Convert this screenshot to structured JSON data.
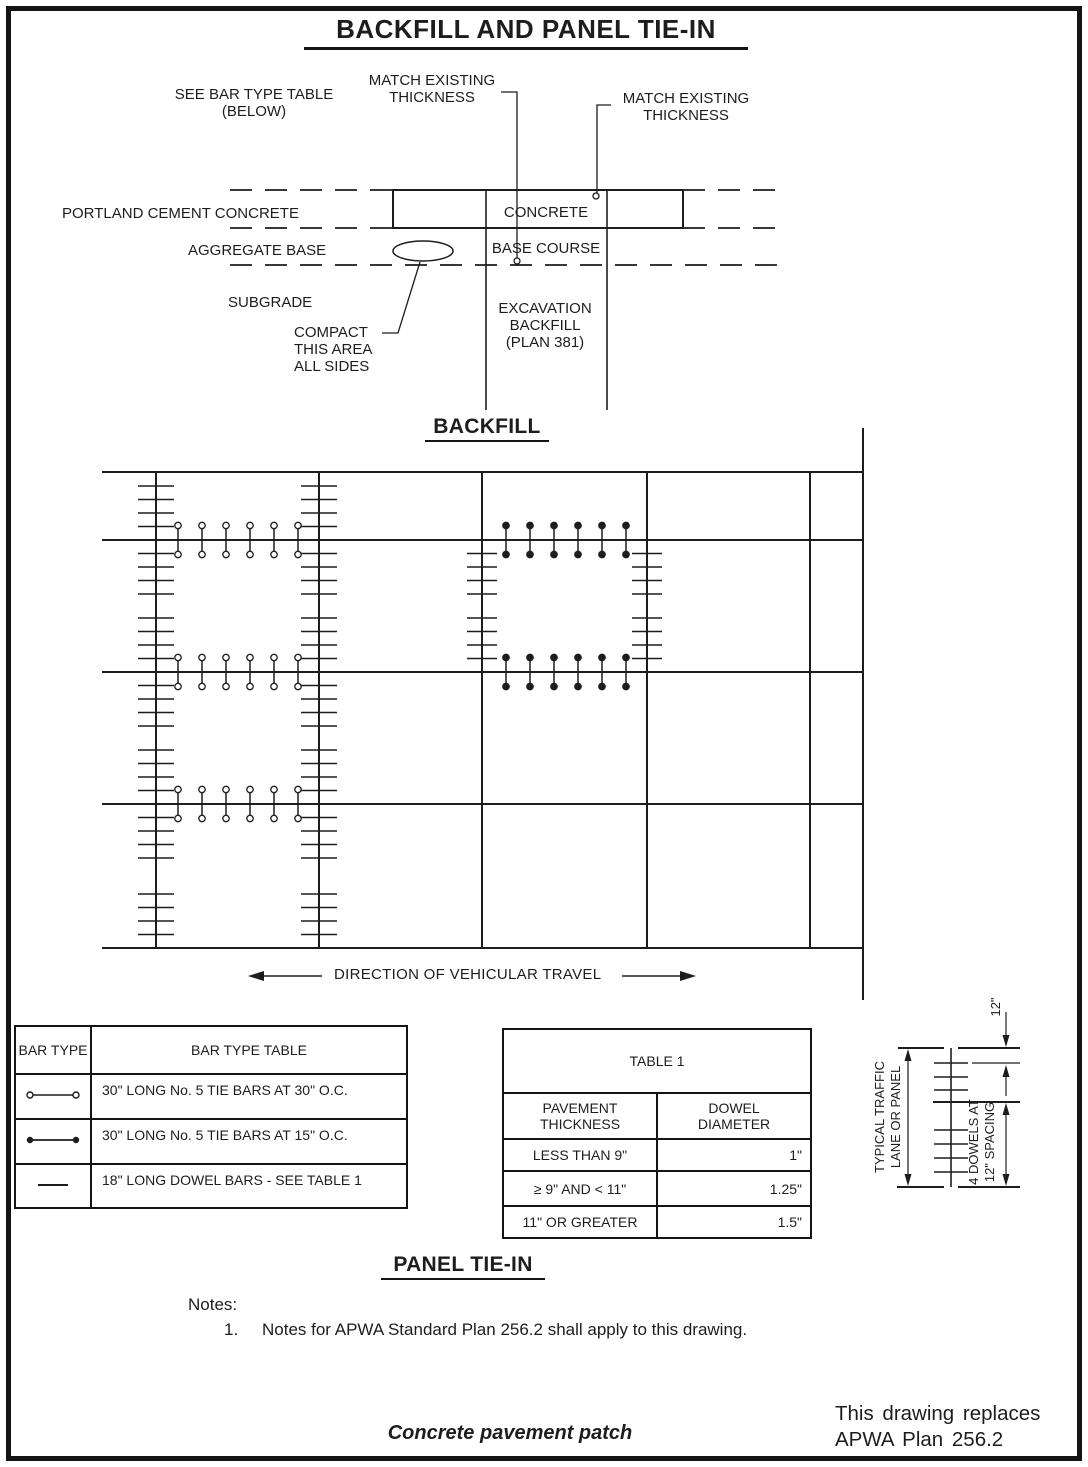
{
  "page": {
    "title": "BACKFILL AND PANEL TIE-IN",
    "section1_heading": "BACKFILL",
    "section2_heading": "PANEL TIE-IN"
  },
  "cross_section": {
    "see_bar_type_table": "SEE BAR TYPE TABLE (BELOW)",
    "match_existing_1": "MATCH EXISTING THICKNESS",
    "match_existing_2": "MATCH EXISTING THICKNESS",
    "portland_cement_concrete": "PORTLAND CEMENT CONCRETE",
    "aggregate_base": "AGGREGATE BASE",
    "subgrade": "SUBGRADE",
    "compact_area": "COMPACT THIS AREA ALL SIDES",
    "concrete": "CONCRETE",
    "base_course": "BASE COURSE",
    "excavation_backfill": "EXCAVATION BACKFILL (PLAN 381)"
  },
  "plan_view": {
    "direction_label": "DIRECTION OF VEHICULAR TRAVEL"
  },
  "detail": {
    "dim_12": "12\"",
    "typical_line1": "TYPICAL TRAFFIC",
    "typical_line2": "LANE OR PANEL",
    "dowels_line1": "4 DOWELS AT",
    "dowels_line2": "12\" SPACING"
  },
  "bar_type_table": {
    "col1_header": "BAR TYPE",
    "col2_header": "BAR TYPE TABLE",
    "rows": [
      {
        "symbol": "tie-bar-open-circles",
        "desc": "30\" LONG No. 5 TIE BARS AT 30\" O.C."
      },
      {
        "symbol": "tie-bar-filled-circles",
        "desc": "30\" LONG No. 5 TIE BARS AT 15\" O.C."
      },
      {
        "symbol": "dowel-bar-plain-line",
        "desc": "18\" LONG DOWEL BARS - SEE TABLE 1"
      }
    ]
  },
  "table1": {
    "title": "TABLE 1",
    "col1_header": "PAVEMENT THICKNESS",
    "col2_header": "DOWEL DIAMETER",
    "rows": [
      {
        "thickness": "LESS THAN 9\"",
        "diameter": "1\""
      },
      {
        "thickness": "≥ 9\" AND < 11\"",
        "diameter": "1.25\""
      },
      {
        "thickness": "11\" OR GREATER",
        "diameter": "1.5\""
      }
    ]
  },
  "notes": {
    "heading": "Notes:",
    "items": [
      {
        "number": "1.",
        "text": "Notes for APWA Standard Plan 256.2 shall apply to this drawing."
      }
    ]
  },
  "footer": {
    "drawing_title": "Concrete pavement patch",
    "replacement_line1": "This drawing replaces",
    "replacement_line2": "APWA Plan 256.2"
  },
  "colors": {
    "ink": "#1d1d1d",
    "background": "#ffffff"
  }
}
